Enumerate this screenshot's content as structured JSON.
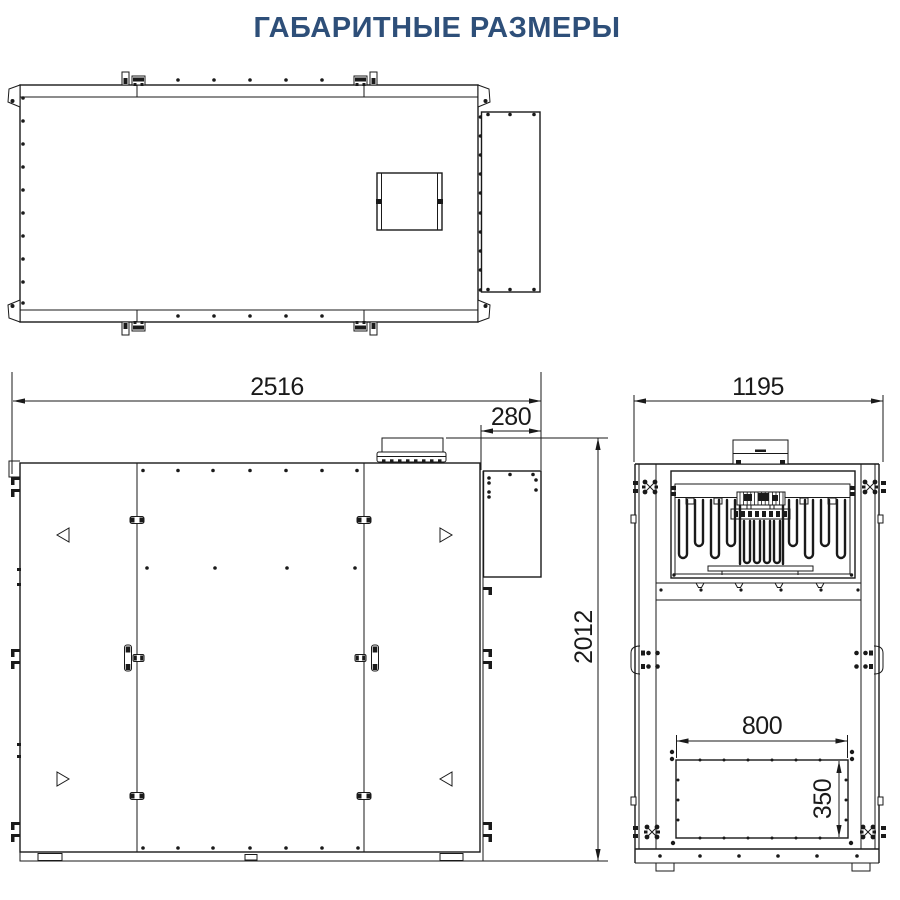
{
  "title": "ГАБАРИТНЫЕ РАЗМЕРЫ",
  "drawing": {
    "dimensions": {
      "overall_width_mm": "2516",
      "duct_depth_mm": "280",
      "overall_height_mm": "2012",
      "overall_depth_mm": "1195",
      "opening_width_mm": "800",
      "opening_height_mm": "350"
    },
    "colors": {
      "line": "#1a1a1a",
      "title_text": "#2e4f79",
      "background": "#ffffff"
    }
  }
}
